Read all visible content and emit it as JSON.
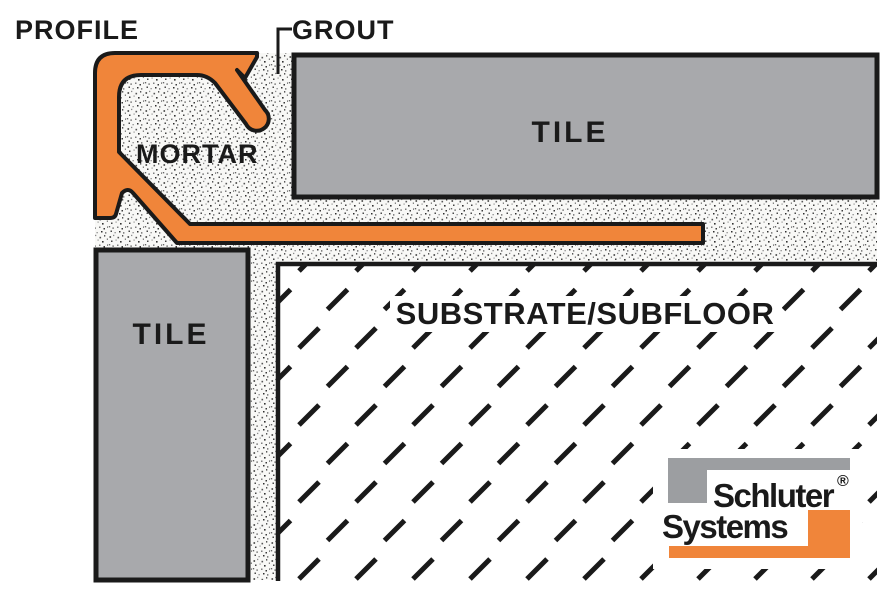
{
  "diagram": {
    "labels": {
      "profile": "PROFILE",
      "grout": "GROUT",
      "mortar": "MORTAR",
      "tile_top": "TILE",
      "tile_left": "TILE",
      "substrate": "SUBSTRATE/SUBFLOOR"
    },
    "logo": {
      "line1": "Schluter",
      "line2": "Systems",
      "registered": "®"
    },
    "colors": {
      "profile_orange": "#F0853A",
      "tile_gray": "#A8A9AC",
      "logo_gray": "#9C9EA1",
      "logo_orange": "#F0853A",
      "line_black": "#1A1A1A"
    }
  }
}
